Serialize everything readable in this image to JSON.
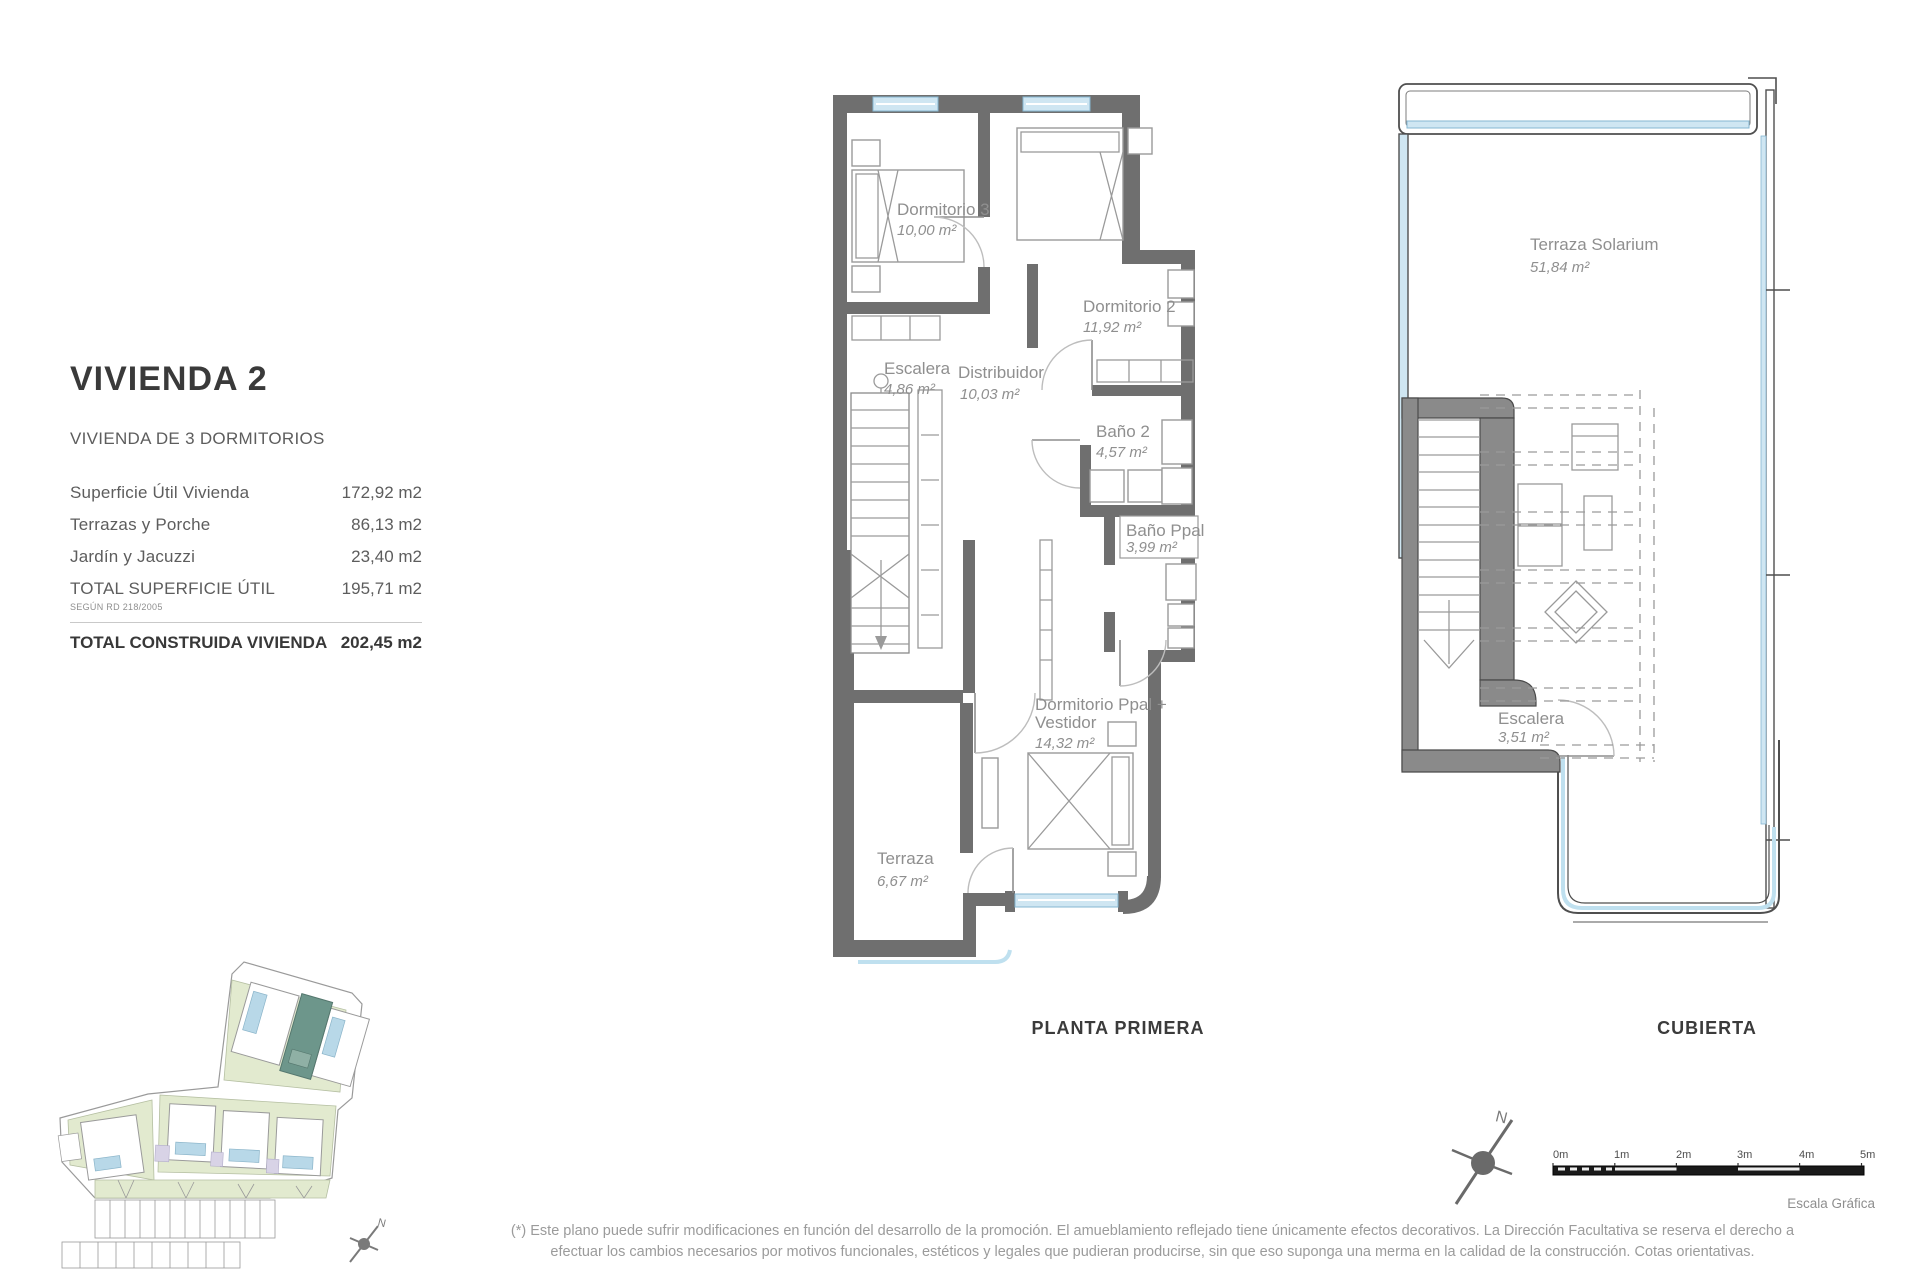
{
  "info_panel": {
    "title": "VIVIENDA 2",
    "subtitle": "VIVIENDA DE 3 DORMITORIOS",
    "rows": [
      {
        "label": "Superficie Útil Vivienda",
        "value": "172,92 m2"
      },
      {
        "label": "Terrazas y Porche",
        "value": "86,13 m2"
      },
      {
        "label": "Jardín y Jacuzzi",
        "value": "23,40 m2"
      },
      {
        "label": "TOTAL SUPERFICIE ÚTIL",
        "note": "SEGÚN RD 218/2005",
        "value": "195,71 m2"
      }
    ],
    "total_row": {
      "label": "TOTAL CONSTRUIDA VIVIENDA",
      "value": "202,45 m2"
    }
  },
  "plans": {
    "planta_primera": {
      "title": "PLANTA PRIMERA",
      "rooms": [
        {
          "name": "Dormitorio 3",
          "area": "10,00 m²"
        },
        {
          "name": "Dormitorio 2",
          "area": "11,92 m²"
        },
        {
          "name": "Escalera",
          "area": "4,86 m²"
        },
        {
          "name": "Distribuidor",
          "area": "10,03 m²"
        },
        {
          "name": "Baño 2",
          "area": "4,57 m²"
        },
        {
          "name": "Baño Ppal",
          "area": "3,99 m²"
        },
        {
          "name": "Dormitorio Ppal +",
          "name2": "Vestidor",
          "area": "14,32 m²"
        },
        {
          "name": "Terraza",
          "area": "6,67 m²"
        }
      ]
    },
    "cubierta": {
      "title": "CUBIERTA",
      "rooms": [
        {
          "name": "Terraza Solarium",
          "area": "51,84 m²"
        },
        {
          "name": "Escalera",
          "area": "3,51 m²"
        }
      ]
    }
  },
  "scale_bar": {
    "labels": [
      "0m",
      "1m",
      "2m",
      "3m",
      "4m",
      "5m"
    ],
    "caption": "Escala Gráfica"
  },
  "compass": {
    "north_label": "N"
  },
  "footer": {
    "line1": "(*) Este plano puede sufrir modificaciones en función del desarrollo de la promoción. El amueblamiento reflejado tiene únicamente efectos decorativos. La Dirección Facultativa se reserva el derecho a",
    "line2": "efectuar los cambios necesarios por motivos funcionales, estéticos y legales que pudieran producirse, sin que eso suponga una merma en la calidad de la construcción. Cotas orientativas."
  },
  "colors": {
    "wall": "#6f6f6f",
    "glass": "#cfe6f2",
    "room_label": "#8f8f8f",
    "highlight_unit": "#6d968b",
    "garden": "#e2eacf",
    "pool": "#b8d8e8"
  }
}
